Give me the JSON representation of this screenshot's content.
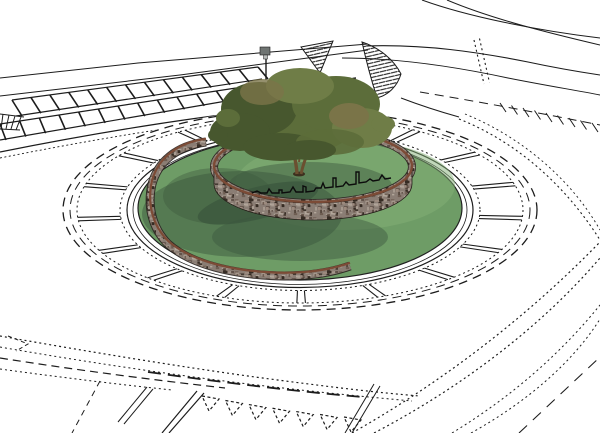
{
  "scene": {
    "description": "3D sketch-style render of a road roundabout: line-art roads and pavement markings surround a shaded grass island with a spiral dry-stone wall, a skyline silhouette sculpture on the wall, and a single tree",
    "style": "white paper with black line work, shaded center island",
    "background": "#ffffff"
  },
  "colors": {
    "paper": "#ffffff",
    "ink": "#1c1c1c",
    "grass_base": "#6e9c66",
    "grass_light": "#84af75",
    "grass_shadow": "#3b573d",
    "stone_base": "#8a7d74",
    "stone_dark": "#57483f",
    "stone_light": "#a99c91",
    "stone_deep": "#362c24",
    "stone_pink": "#9c8a7e",
    "coping": "#7c4b36",
    "foliage_dark": "#47572e",
    "foliage_mid": "#5c6d3a",
    "foliage_light": "#6f7d47",
    "foliage_brown": "#7a7448",
    "trunk": "#6b4f30",
    "sign_grey": "#6f7472",
    "sign_face": "#b9bdbb",
    "arrow_grey": "#a0a6a4",
    "silhouette": "#0c0c0c"
  },
  "ring": {
    "tick_count": 17,
    "center_x": 300,
    "center_y": 210
  },
  "markings": {
    "yield_triangle_count": 7,
    "crosswalk_rows": 2,
    "crosswalk_stripes_per_row": 13,
    "gore_tick_count": 9
  },
  "island": {
    "tree_count": 1,
    "wall_type": "spiral dry-stone wall",
    "ornament": "black skyline silhouette on inner wall"
  }
}
